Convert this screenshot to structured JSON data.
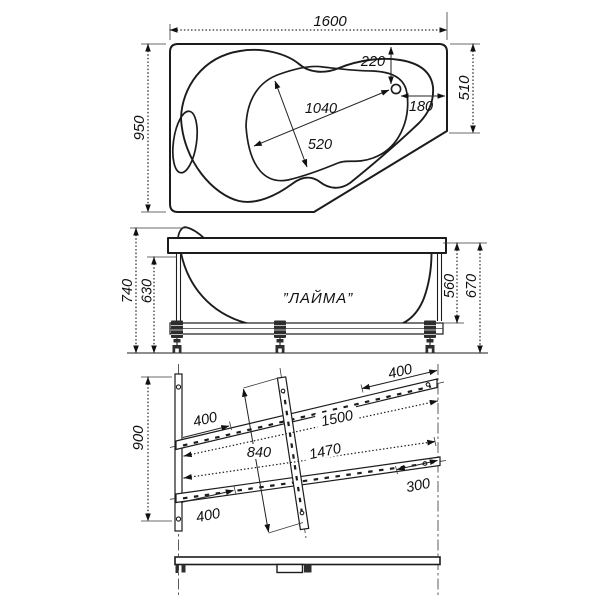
{
  "drawing": {
    "plan": {
      "overall_length": "1600",
      "overall_width": "950",
      "right_edge_length": "510",
      "drain_offset_top": "220",
      "drain_offset_right": "180",
      "basin_length": "1040",
      "basin_width": "520"
    },
    "side": {
      "model_label": "”ЛАЙМА”",
      "height_rim_left": "740",
      "height_underside_left": "630",
      "height_underside_right": "560",
      "height_rim_right": "670"
    },
    "frame": {
      "frame_width": "900",
      "upper_rail_length": "1500",
      "lower_rail_length": "1470",
      "cross_member_length": "840",
      "upper_left_offset": "400",
      "upper_right_offset": "400",
      "lower_left_offset": "400",
      "lower_right_offset": "300"
    }
  }
}
